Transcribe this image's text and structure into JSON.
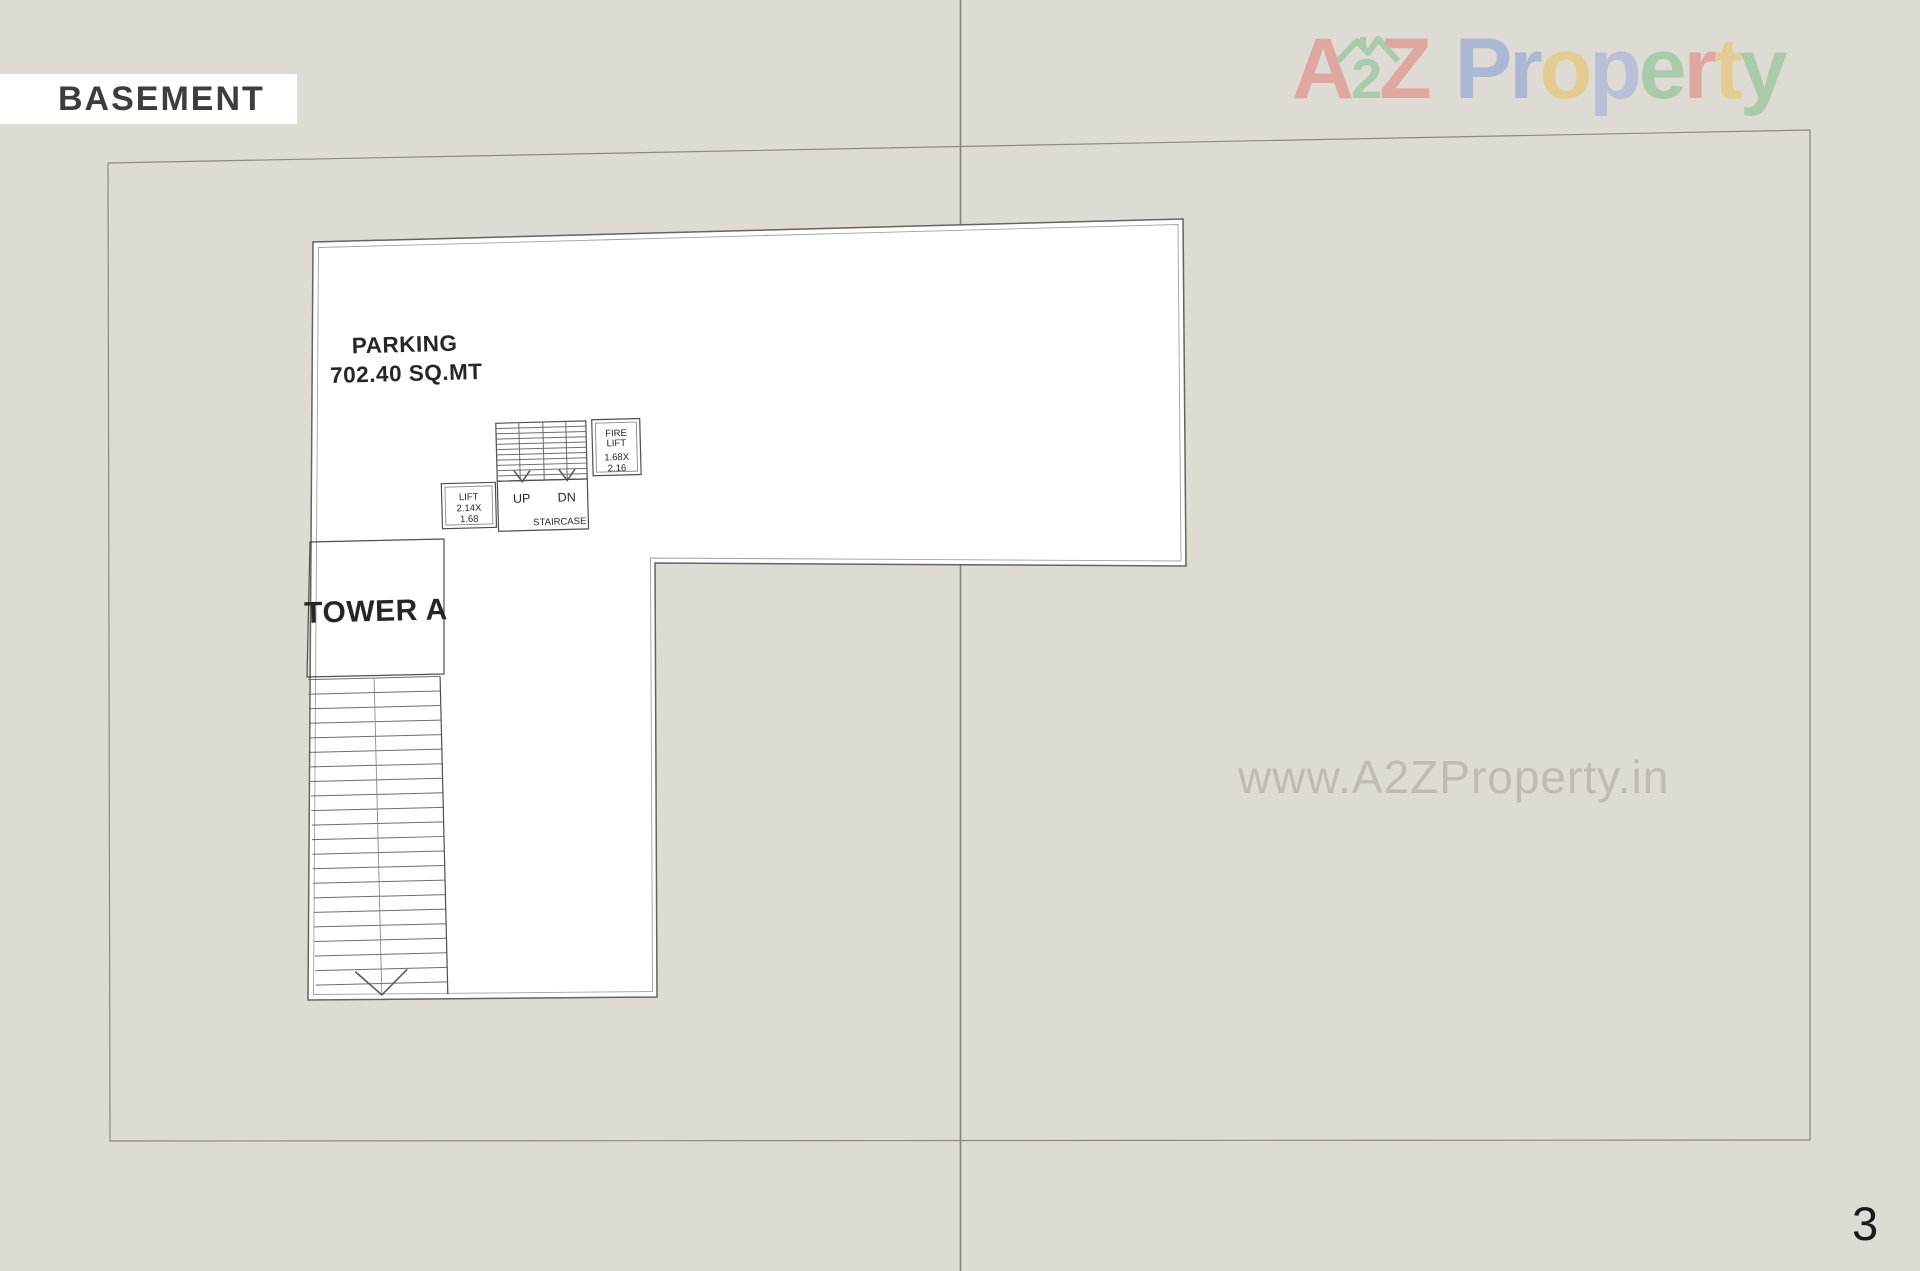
{
  "page": {
    "label": "BASEMENT",
    "page_number": "3",
    "background_color": "#dedad4"
  },
  "logo": {
    "name": "A2Z Property",
    "house_icon_color": "#58b368",
    "letters": [
      {
        "ch": "A",
        "color": "#e4574f",
        "small": false
      },
      {
        "ch": "2",
        "color": "#58b368",
        "small": true
      },
      {
        "ch": "Z",
        "color": "#e4574f",
        "small": false
      },
      {
        "ch": " ",
        "color": "",
        "small": false
      },
      {
        "ch": "P",
        "color": "#5b7fd6",
        "small": false
      },
      {
        "ch": "r",
        "color": "#5b7fd6",
        "small": false
      },
      {
        "ch": "o",
        "color": "#f0b429",
        "small": false
      },
      {
        "ch": "p",
        "color": "#7b96dd",
        "small": false
      },
      {
        "ch": "e",
        "color": "#58b368",
        "small": false
      },
      {
        "ch": "r",
        "color": "#e4574f",
        "small": false
      },
      {
        "ch": "t",
        "color": "#f0b429",
        "small": false
      },
      {
        "ch": "y",
        "color": "#58b368",
        "small": false
      }
    ]
  },
  "watermark": {
    "text": "www.A2ZProperty.in"
  },
  "plan": {
    "parking_title": "PARKING",
    "parking_area": "702.40 SQ.MT",
    "tower_label": "TOWER A",
    "staircase": {
      "up": "UP",
      "down": "DN",
      "label": "STAIRCASE"
    },
    "lift": {
      "line1": "LIFT",
      "line2": "2.14X",
      "line3": "1.68"
    },
    "fire_lift": {
      "line1": "FIRE",
      "line2": "LIFT",
      "line3": "1.68X",
      "line4": "2.16"
    }
  }
}
